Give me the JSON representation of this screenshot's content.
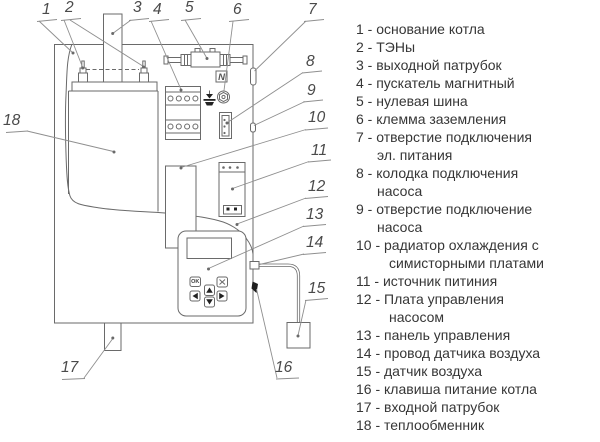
{
  "diagram": {
    "n_label": "N",
    "ok_label": "OK",
    "callouts": [
      {
        "n": "1",
        "x": 42,
        "y": 2
      },
      {
        "n": "2",
        "x": 65,
        "y": 0
      },
      {
        "n": "3",
        "x": 133,
        "y": 0
      },
      {
        "n": "4",
        "x": 153,
        "y": 2
      },
      {
        "n": "5",
        "x": 185,
        "y": 0
      },
      {
        "n": "6",
        "x": 233,
        "y": 2
      },
      {
        "n": "7",
        "x": 308,
        "y": 2
      },
      {
        "n": "8",
        "x": 306,
        "y": 54
      },
      {
        "n": "9",
        "x": 307,
        "y": 83
      },
      {
        "n": "10",
        "x": 308,
        "y": 110
      },
      {
        "n": "11",
        "x": 311,
        "y": 143
      },
      {
        "n": "12",
        "x": 308,
        "y": 179
      },
      {
        "n": "13",
        "x": 306,
        "y": 207
      },
      {
        "n": "14",
        "x": 306,
        "y": 235
      },
      {
        "n": "15",
        "x": 308,
        "y": 281
      },
      {
        "n": "16",
        "x": 275,
        "y": 360
      },
      {
        "n": "17",
        "x": 61,
        "y": 360
      },
      {
        "n": "18",
        "x": 3,
        "y": 113
      }
    ]
  },
  "legend": {
    "items": [
      {
        "num": "1",
        "lines": [
          "основание котла"
        ]
      },
      {
        "num": "2",
        "lines": [
          "ТЭНы"
        ]
      },
      {
        "num": "3",
        "lines": [
          "выходной патрубок"
        ]
      },
      {
        "num": "4",
        "lines": [
          "пускатель магнитный"
        ]
      },
      {
        "num": "5",
        "lines": [
          "нулевая шина"
        ]
      },
      {
        "num": "6",
        "lines": [
          "клемма заземления"
        ]
      },
      {
        "num": "7",
        "lines": [
          "отверстие подключения",
          "эл. питания"
        ]
      },
      {
        "num": "8",
        "lines": [
          "колодка подключения",
          "насоса"
        ]
      },
      {
        "num": "9",
        "lines": [
          "отверстие подключение",
          "насоса"
        ]
      },
      {
        "num": "10",
        "lines": [
          "радиатор охлаждения с",
          "симисторными платами"
        ]
      },
      {
        "num": "11",
        "lines": [
          "источник питиния"
        ]
      },
      {
        "num": "12",
        "lines": [
          "Плата управления",
          "насосом"
        ]
      },
      {
        "num": "13",
        "lines": [
          "панель управления"
        ]
      },
      {
        "num": "14",
        "lines": [
          "провод датчика воздуха"
        ]
      },
      {
        "num": "15",
        "lines": [
          "датчик воздуха"
        ]
      },
      {
        "num": "16",
        "lines": [
          "клавиша питание котла"
        ]
      },
      {
        "num": "17",
        "lines": [
          "входной патрубок"
        ]
      },
      {
        "num": "18",
        "lines": [
          "теплообменник"
        ]
      }
    ]
  },
  "colors": {
    "drawing_line": "#6a6a6a",
    "leader_line": "#8f8f8f",
    "text": "#363636",
    "filled_shape": "#222222"
  }
}
